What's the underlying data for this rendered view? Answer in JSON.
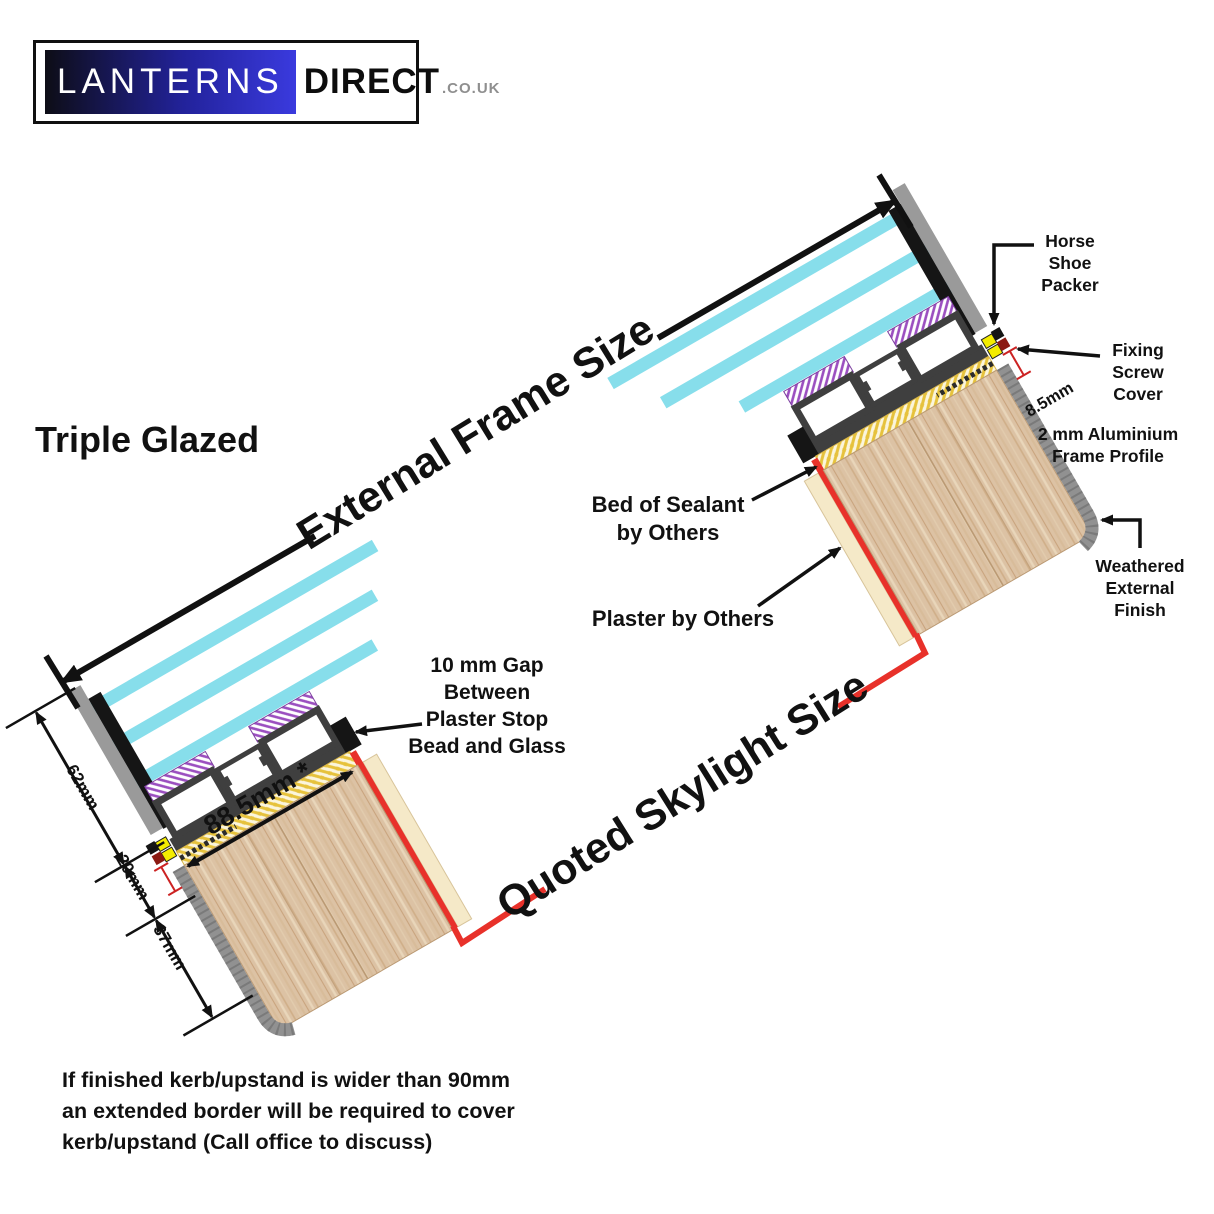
{
  "logo": {
    "brand_primary": "LANTERNS",
    "brand_secondary": "DIRECT",
    "brand_suffix": ".CO.UK"
  },
  "headings": {
    "glazing_type": "Triple Glazed"
  },
  "dimensions": {
    "external_frame_size": "External Frame Size",
    "quoted_skylight_size": "Quoted Skylight Size",
    "kerb_face_width": "88.5mm *",
    "frame_glass_height": "62mm",
    "frame_base_depth": "20mm",
    "kerb_exposure": "37mm",
    "screw_offset": "8.5mm"
  },
  "annotations": {
    "horse_shoe_packer": {
      "lines": [
        "Horse",
        "Shoe",
        "Packer"
      ]
    },
    "fixing_screw_cover": {
      "lines": [
        "Fixing",
        "Screw",
        "Cover"
      ]
    },
    "aluminium_frame_profile": {
      "lines": [
        "2 mm Aluminium",
        "Frame Profile"
      ]
    },
    "weathered_external_finish": {
      "lines": [
        "Weathered",
        "External",
        "Finish"
      ]
    },
    "bed_of_sealant": {
      "lines": [
        "Bed of Sealant",
        "by Others"
      ]
    },
    "plaster_by_others": "Plaster by Others",
    "plaster_gap": {
      "lines": [
        "10 mm Gap",
        "Between",
        "Plaster Stop",
        "Bead and Glass"
      ]
    }
  },
  "footer": {
    "lines": [
      "If finished kerb/upstand is wider than 90mm",
      "an extended border will be required to cover",
      "kerb/upstand (Call office to discuss)"
    ]
  },
  "colors": {
    "glass_cyan": "#87DEEB",
    "accent_red": "#E8312A",
    "frame_dark": "#3F3F3F",
    "capping_grey": "#9A9A9A",
    "wood_base": "#DCC2A4",
    "sealant_yellow": "#E6C23C",
    "gasket_purple": "#9B4FC0",
    "packer_yellow": "#F4EC00",
    "plaster_cream": "#F5E9C8",
    "logo_blue": "#3A3ADE"
  }
}
